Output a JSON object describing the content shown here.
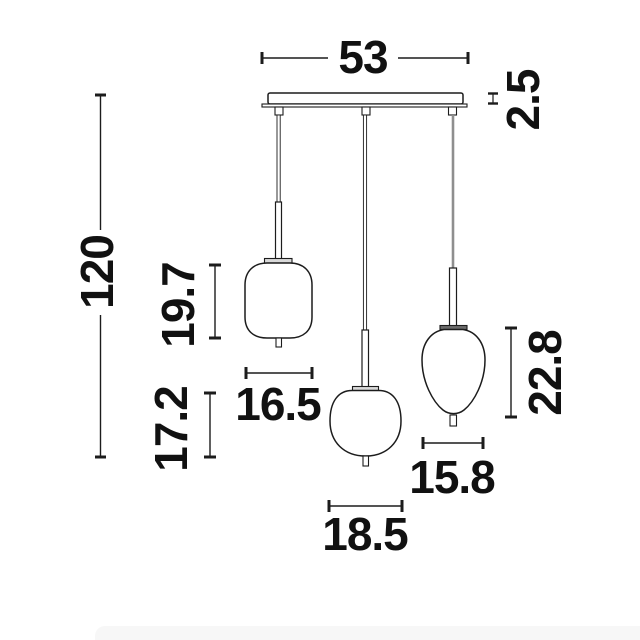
{
  "page": {
    "background": "#ffffff",
    "footer_band_color": "#f7f7f7"
  },
  "drawing": {
    "type": "technical-dimension-drawing",
    "subject": "three-light pendant lamp with ceiling canopy and three glass shades",
    "line_color": "#1c1c1c",
    "text_color": "#111111",
    "cord_color": "#8f8f8f",
    "cap_light_color": "#d9d9d9",
    "cap_dark_color": "#6b6b6b",
    "dimensions": {
      "canopy_width": "53",
      "canopy_thickness": "2.5",
      "overall_height": "120",
      "left_shade_height": "19.7",
      "left_shade_width": "16.5",
      "middle_shade_height": "17.2",
      "middle_shade_width": "18.5",
      "right_shade_height": "22.8",
      "right_shade_width": "15.8"
    }
  }
}
